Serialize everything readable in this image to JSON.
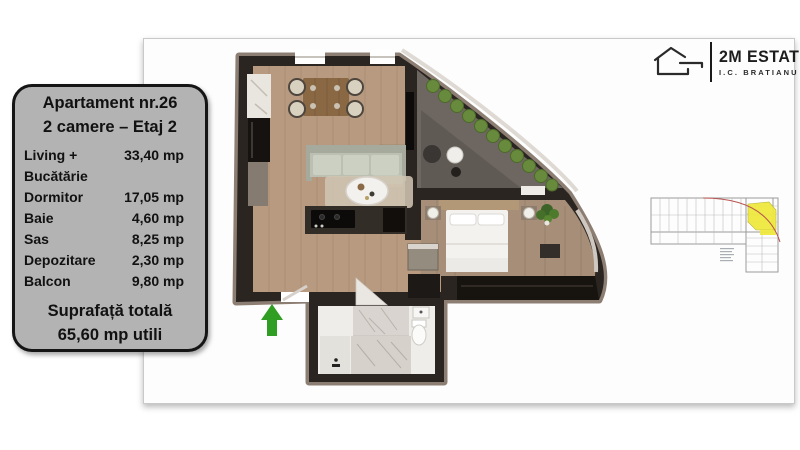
{
  "panel": {
    "title_line1": "Apartament nr.26",
    "title_line2": "2 camere – Etaj 2",
    "rooms": [
      {
        "label": "Living +",
        "label2": "Bucătărie",
        "value": "33,40 mp"
      },
      {
        "label": "Dormitor",
        "value": "17,05 mp"
      },
      {
        "label": "Baie",
        "value": "4,60 mp"
      },
      {
        "label": "Sas",
        "value": "8,25 mp"
      },
      {
        "label": "Depozitare",
        "value": "2,30 mp"
      },
      {
        "label": "Balcon",
        "value": "9,80 mp"
      }
    ],
    "total_label": "Suprafață totală",
    "total_value": "65,60 mp utili"
  },
  "logo": {
    "brand": "2M ESTATE",
    "location": "I.C. BRATIANU"
  },
  "colors": {
    "panel_bg": "#b3b3b3",
    "panel_border": "#151515",
    "arrow_green": "#2f9e23",
    "highlight_yellow": "#efe93f",
    "red_arc": "#b85450",
    "wood": "#b79a80",
    "wood_dark": "#a68e78",
    "wall": "#2b2522",
    "wall_outer": "#8d7e73",
    "balcony_floor": "#6e6761",
    "hedge_green": "#678a3c",
    "sofa": "#bcc0b2",
    "rug": "#cfc4b2",
    "marble": "#e9e5df",
    "bath_floor": "#efede9"
  }
}
